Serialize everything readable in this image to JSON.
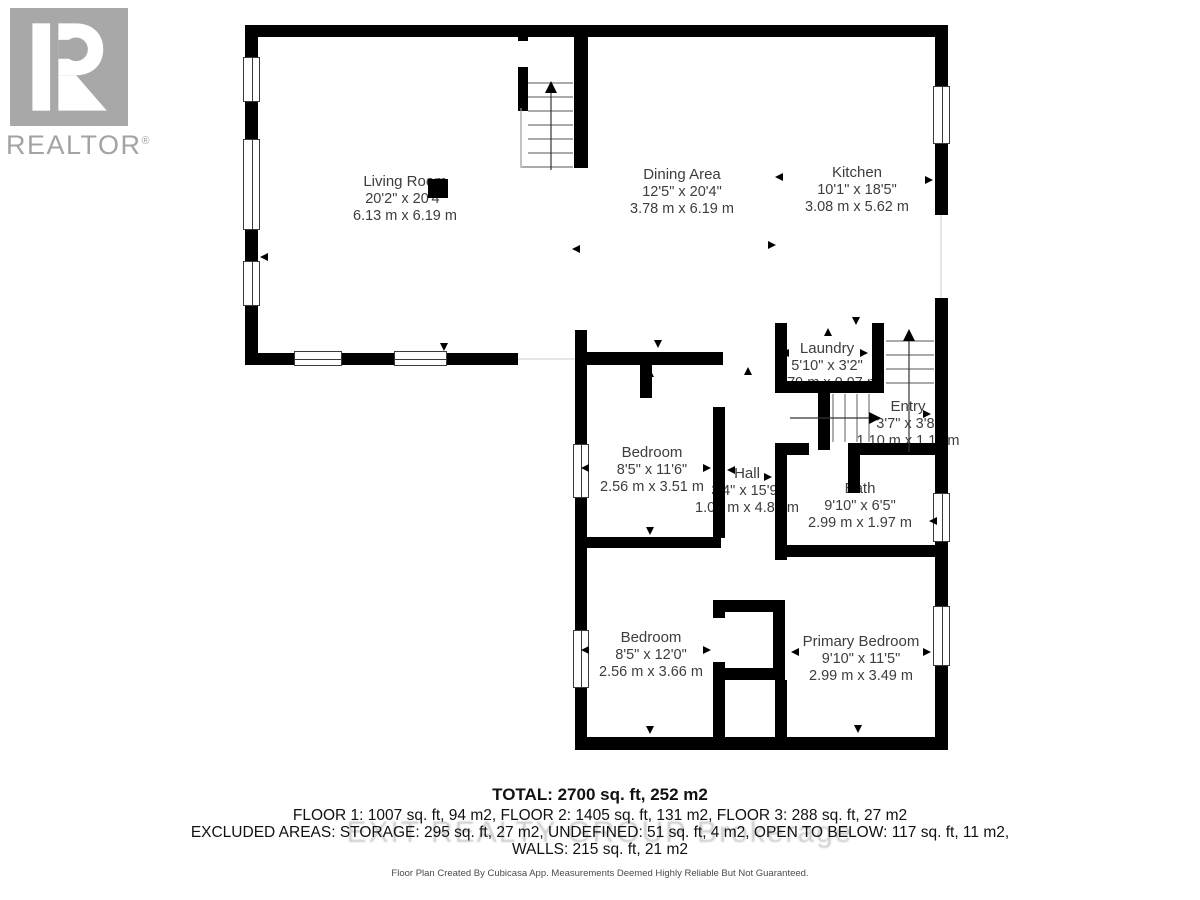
{
  "logo": {
    "brand": "REALTOR",
    "registered": "®"
  },
  "rooms": {
    "living": {
      "name": "Living Room",
      "imperial": "20'2\" x 20'4\"",
      "metric": "6.13 m x 6.19 m"
    },
    "dining": {
      "name": "Dining Area",
      "imperial": "12'5\" x 20'4\"",
      "metric": "3.78 m x 6.19 m"
    },
    "kitchen": {
      "name": "Kitchen",
      "imperial": "10'1\" x 18'5\"",
      "metric": "3.08 m x 5.62 m"
    },
    "laundry": {
      "name": "Laundry",
      "imperial": "5'10\" x 3'2\"",
      "metric": "1.79 m x 0.97 m"
    },
    "entry": {
      "name": "Entry",
      "imperial": "3'7\" x 3'8\"",
      "metric": "1.10 m x 1.11 m"
    },
    "bedroom1": {
      "name": "Bedroom",
      "imperial": "8'5\" x 11'6\"",
      "metric": "2.56 m x 3.51 m"
    },
    "hall": {
      "name": "Hall",
      "imperial": "3'4\" x 15'9\"",
      "metric": "1.03 m x 4.81 m"
    },
    "bath": {
      "name": "Bath",
      "imperial": "9'10\" x 6'5\"",
      "metric": "2.99 m x 1.97 m"
    },
    "bedroom2": {
      "name": "Bedroom",
      "imperial": "8'5\" x 12'0\"",
      "metric": "2.56 m x 3.66 m"
    },
    "primary": {
      "name": "Primary Bedroom",
      "imperial": "9'10\" x 11'5\"",
      "metric": "2.99 m x 3.49 m"
    }
  },
  "summary": {
    "total": "TOTAL: 2700 sq. ft, 252 m2",
    "floors": "FLOOR 1: 1007 sq. ft, 94 m2, FLOOR 2: 1405 sq. ft, 131 m2, FLOOR 3: 288 sq. ft, 27 m2",
    "excluded": "EXCLUDED AREAS: STORAGE: 295 sq. ft, 27 m2, UNDEFINED: 51 sq. ft, 4 m2, OPEN TO BELOW: 117 sq. ft, 11 m2,",
    "walls": "WALLS: 215 sq. ft, 21 m2",
    "disclaimer": "Floor Plan Created By Cubicasa App. Measurements Deemed Highly Reliable But Not Guaranteed."
  },
  "watermark": "EXIT REALTY GROUP Brokerage",
  "colors": {
    "wall": "#000000",
    "label": "#3d3d3d",
    "logo_gray": "#a3a3a3",
    "tread_gray": "#777777"
  }
}
